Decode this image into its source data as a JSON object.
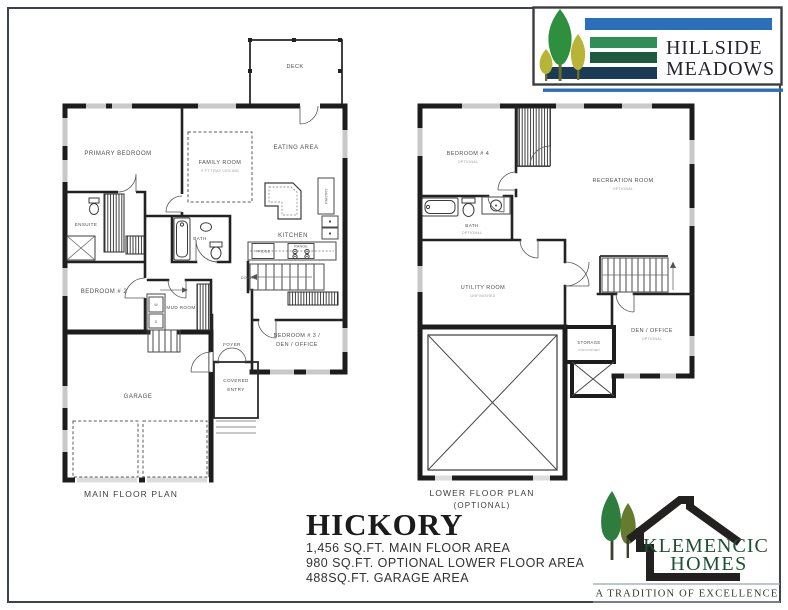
{
  "header_logo": {
    "name_line1": "HILLSIDE",
    "name_line2": "MEADOWS",
    "colors": {
      "stripe_blue": "#2a6fb7",
      "stripe_green": "#2f8f55",
      "stripe_dark_green": "#1e5a40",
      "stripe_navy": "#1b3a55",
      "tree_green": "#2e8f3e",
      "tree_yellow": "#b7b436",
      "text": "#23232e",
      "border": "#3b3d40"
    }
  },
  "builder_logo": {
    "name_line1": "KLEMENCIC",
    "name_line2": "HOMES",
    "tagline": "A TRADITION OF EXCELLENCE",
    "colors": {
      "leaf_green": "#2e7c3e",
      "leaf_olive": "#657b2d",
      "house_black": "#232020",
      "text_green": "#1c4f33",
      "tagline_text": "#37382f",
      "rule_gray": "#9aa3a8"
    }
  },
  "title_block": {
    "plan_name": "HICKORY",
    "spec_lines": [
      "1,456 SQ.FT. MAIN FLOOR AREA",
      "980 SQ.FT. OPTIONAL LOWER FLOOR AREA",
      "488SQ.FT. GARAGE AREA"
    ]
  },
  "main_floor": {
    "caption": "MAIN FLOOR PLAN",
    "labels": {
      "deck": "DECK",
      "primary_bedroom": "PRIMARY BEDROOM",
      "family_room": "FAMILY ROOM",
      "family_room_note": "9 FT TRAY CEILING",
      "eating_area": "EATING AREA",
      "kitchen": "KITCHEN",
      "fridge": "FRIDGE",
      "range": "RANGE",
      "pantry": "PANTRY",
      "ensuite": "ENSUITE",
      "bath": "BATH",
      "bedroom2": "BEDROOM # 2",
      "mud_room": "MUD ROOM",
      "foyer": "FOYER",
      "covered_entry_line1": "COVERED",
      "covered_entry_line2": "ENTRY",
      "bedroom3_line1": "BEDROOM # 3 /",
      "bedroom3_line2": "DEN / OFFICE",
      "garage": "GARAGE",
      "down": "DOWN",
      "washer": "W",
      "dryer": "D"
    }
  },
  "lower_floor": {
    "caption_line1": "LOWER FLOOR PLAN",
    "caption_line2": "(OPTIONAL)",
    "labels": {
      "bedroom4": "BEDROOM # 4",
      "bedroom4_note": "OPTIONAL",
      "recreation_room": "RECREATION ROOM",
      "recreation_room_note": "OPTIONAL",
      "bath": "BATH",
      "bath_note": "OPTIONAL",
      "utility_room": "UTILITY ROOM",
      "utility_room_note": "UNFINISHED",
      "storage": "STORAGE",
      "storage_note": "UNFINISHED",
      "den_office": "DEN / OFFICE",
      "den_office_note": "OPTIONAL"
    }
  }
}
